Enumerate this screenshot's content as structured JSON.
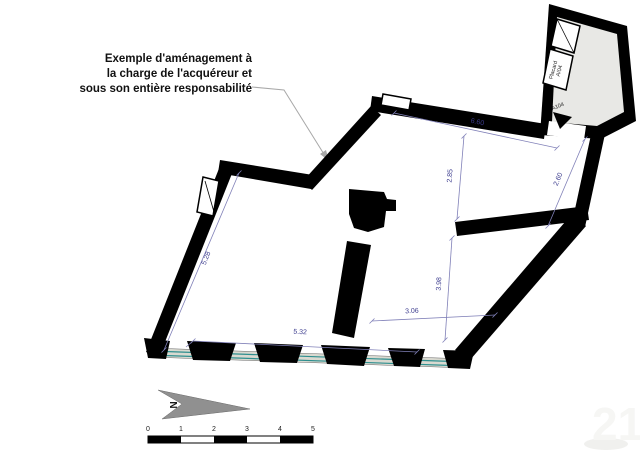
{
  "annotation": {
    "line1": "Exemple d'aménagement à",
    "line2": "la charge de l'acquéreur et",
    "line3": "sous son entière responsabilité"
  },
  "plan": {
    "dimensions": {
      "top_width": "6.60",
      "upper_height": "2.85",
      "right_height": "2.60",
      "left_length": "5.28",
      "lower_room_height": "3.98",
      "lower_room_width": "3.06",
      "bottom_width": "5.32"
    },
    "labels": {
      "closet_name": "Placard",
      "closet_ref": "A/04",
      "door_ref": "A104"
    }
  },
  "compass": {
    "north_letter": "N"
  },
  "scale_bar": {
    "ticks": [
      "0",
      "1",
      "2",
      "3",
      "4",
      "5"
    ]
  },
  "watermark": {
    "text": "21"
  },
  "colors": {
    "wall": "#000000",
    "dimension_line": "#8080b8",
    "dimension_text": "#3c3c8e",
    "room_fill": "#e8e8e5",
    "window_glass": "#2e8f8f",
    "window_sill": "#d9d9d0",
    "north_arrow": "#909090",
    "leader_line": "#a8a8a8"
  }
}
